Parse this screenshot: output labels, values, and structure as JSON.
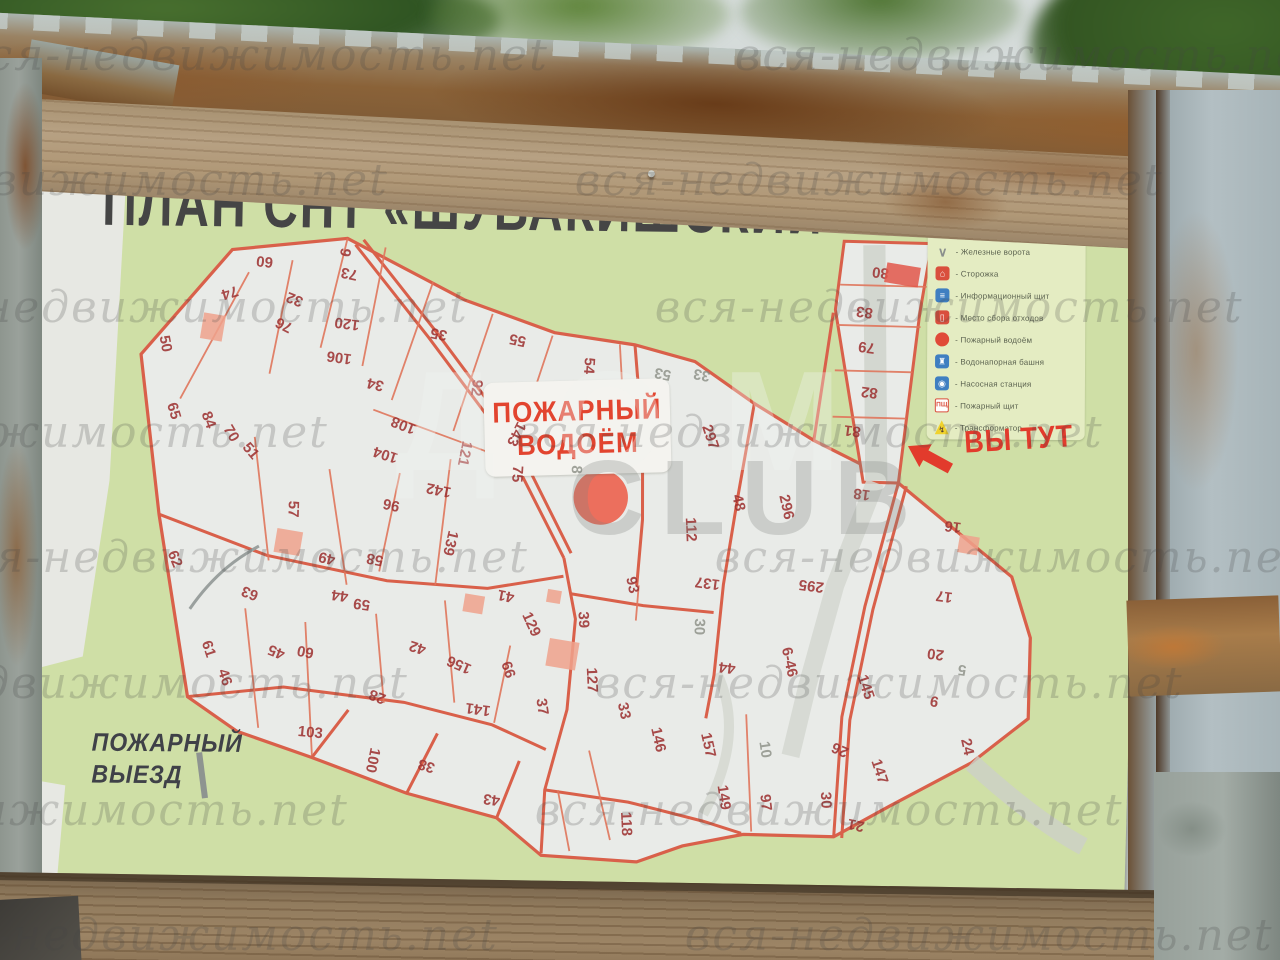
{
  "watermark": {
    "text": "вся-недвижимость.net",
    "center_top": "ДОМ",
    "center_bottom": "CLUB"
  },
  "poster": {
    "title": "ПЛАН СНТ «ШУВАКИШСКИЙ»",
    "you_are_here": "ВЫ ТУТ",
    "fire_pond": {
      "line1": "ПОЖАРНЫЙ",
      "line2": "ВОДОЁМ"
    },
    "fire_exit": {
      "line1": "ПОЖАРНЫЙ",
      "line2": "ВЫЕЗД"
    },
    "legend": {
      "title": "Условные обозначения:",
      "items": [
        {
          "icon": "iron-gates-icon",
          "label": "- Железные ворота"
        },
        {
          "icon": "guard-house-icon",
          "label": "- Сторожка"
        },
        {
          "icon": "info-board-icon",
          "label": "- Информационный щит"
        },
        {
          "icon": "waste-point-icon",
          "label": "- Место сбора отходов"
        },
        {
          "icon": "fire-pond-icon",
          "label": "- Пожарный водоём"
        },
        {
          "icon": "water-tower-icon",
          "label": "- Водонапорная башня"
        },
        {
          "icon": "pump-station-icon",
          "label": "- Насосная станция"
        },
        {
          "icon": "fire-shield-icon",
          "label": "- Пожарный щит",
          "icon_text": "ПЩ"
        },
        {
          "icon": "transformer-icon",
          "label": "- Трансформатор"
        }
      ]
    },
    "colors": {
      "accent_red": "#e23b2c",
      "street_orange": "#d9604a",
      "plot_number_red": "#9e3434",
      "map_green": "#cfdfa6",
      "map_white": "#e9ebe8",
      "legend_bg": "#e4ecc2"
    }
  },
  "map": {
    "fire_pond_circle": {
      "x": 580,
      "y": 349,
      "rad": 27
    },
    "buildings": [
      {
        "x": 273,
        "y": 405,
        "w": 26,
        "h": 24,
        "c": "#efa28c"
      },
      {
        "x": 192,
        "y": 192,
        "w": 22,
        "h": 26,
        "c": "#efa28c"
      },
      {
        "x": 880,
        "y": 122,
        "w": 34,
        "h": 20,
        "c": "#e2574a"
      },
      {
        "x": 953,
        "y": 390,
        "w": 20,
        "h": 18,
        "c": "#efa28c"
      },
      {
        "x": 550,
        "y": 510,
        "w": 30,
        "h": 28,
        "c": "#efa28c"
      },
      {
        "x": 460,
        "y": 462,
        "w": 20,
        "h": 18,
        "c": "#efa28c"
      },
      {
        "x": 540,
        "y": 452,
        "w": 14,
        "h": 13,
        "c": "#efa28c"
      }
    ],
    "plots": [
      {
        "n": "50",
        "x": 145,
        "y": 210,
        "r": 78
      },
      {
        "n": "65",
        "x": 155,
        "y": 277,
        "r": 72
      },
      {
        "n": "74",
        "x": 208,
        "y": 157,
        "r": 162
      },
      {
        "n": "84",
        "x": 190,
        "y": 285,
        "r": 68
      },
      {
        "n": "70",
        "x": 213,
        "y": 298,
        "r": 58
      },
      {
        "n": "51",
        "x": 233,
        "y": 315,
        "r": 48
      },
      {
        "n": "60",
        "x": 242,
        "y": 125,
        "r": 185
      },
      {
        "n": "76",
        "x": 263,
        "y": 188,
        "r": 205
      },
      {
        "n": "32",
        "x": 273,
        "y": 162,
        "r": 200
      },
      {
        "n": "73",
        "x": 327,
        "y": 135,
        "r": 190
      },
      {
        "n": "9",
        "x": 322,
        "y": 114,
        "r": 100
      },
      {
        "n": "120",
        "x": 326,
        "y": 185,
        "r": 186
      },
      {
        "n": "106",
        "x": 319,
        "y": 219,
        "r": 186
      },
      {
        "n": "34",
        "x": 356,
        "y": 245,
        "r": 192
      },
      {
        "n": "35",
        "x": 418,
        "y": 193,
        "r": 190
      },
      {
        "n": "55",
        "x": 497,
        "y": 197,
        "r": 190
      },
      {
        "n": "92",
        "x": 457,
        "y": 246,
        "r": 96
      },
      {
        "n": "54",
        "x": 569,
        "y": 221,
        "r": 92
      },
      {
        "n": "108",
        "x": 385,
        "y": 285,
        "r": 200
      },
      {
        "n": "104",
        "x": 368,
        "y": 315,
        "r": 196
      },
      {
        "n": "121",
        "x": 447,
        "y": 312,
        "r": 100
      },
      {
        "n": "142",
        "x": 422,
        "y": 349,
        "r": 190
      },
      {
        "n": "143",
        "x": 498,
        "y": 291,
        "r": 115
      },
      {
        "n": "75",
        "x": 500,
        "y": 331,
        "r": 92
      },
      {
        "n": "96",
        "x": 375,
        "y": 365,
        "r": 190
      },
      {
        "n": "139",
        "x": 435,
        "y": 402,
        "r": 102
      },
      {
        "n": "57",
        "x": 277,
        "y": 372,
        "r": 90
      },
      {
        "n": "58",
        "x": 360,
        "y": 420,
        "r": 190
      },
      {
        "n": "49",
        "x": 312,
        "y": 420,
        "r": 192
      },
      {
        "n": "44",
        "x": 326,
        "y": 457,
        "r": 186
      },
      {
        "n": "59",
        "x": 348,
        "y": 465,
        "r": 186
      },
      {
        "n": "62",
        "x": 160,
        "y": 425,
        "r": 66
      },
      {
        "n": "63",
        "x": 236,
        "y": 457,
        "r": 200
      },
      {
        "n": "61",
        "x": 196,
        "y": 514,
        "r": 70
      },
      {
        "n": "46",
        "x": 213,
        "y": 542,
        "r": 70
      },
      {
        "n": "45",
        "x": 264,
        "y": 515,
        "r": 200
      },
      {
        "n": "60",
        "x": 293,
        "y": 514,
        "r": 190
      },
      {
        "n": "42",
        "x": 405,
        "y": 507,
        "r": 196
      },
      {
        "n": "156",
        "x": 447,
        "y": 523,
        "r": 202
      },
      {
        "n": "41",
        "x": 492,
        "y": 453,
        "r": 190
      },
      {
        "n": "129",
        "x": 518,
        "y": 481,
        "r": 64
      },
      {
        "n": "39",
        "x": 570,
        "y": 475,
        "r": 86
      },
      {
        "n": "66",
        "x": 496,
        "y": 527,
        "r": 70
      },
      {
        "n": "37",
        "x": 531,
        "y": 563,
        "r": 80
      },
      {
        "n": "127",
        "x": 580,
        "y": 535,
        "r": 86
      },
      {
        "n": "33",
        "x": 613,
        "y": 565,
        "r": 76
      },
      {
        "n": "146",
        "x": 648,
        "y": 593,
        "r": 76
      },
      {
        "n": "103",
        "x": 300,
        "y": 595,
        "r": 4
      },
      {
        "n": "100",
        "x": 363,
        "y": 621,
        "r": 100
      },
      {
        "n": "38",
        "x": 417,
        "y": 625,
        "r": 196
      },
      {
        "n": "28",
        "x": 366,
        "y": 557,
        "r": 200
      },
      {
        "n": "141",
        "x": 467,
        "y": 567,
        "r": 186
      },
      {
        "n": "43",
        "x": 483,
        "y": 657,
        "r": 186
      },
      {
        "n": "118",
        "x": 618,
        "y": 678,
        "r": 86
      },
      {
        "n": "157",
        "x": 698,
        "y": 597,
        "r": 76
      },
      {
        "n": "10",
        "x": 755,
        "y": 600,
        "r": 80,
        "g": 1
      },
      {
        "n": "149",
        "x": 715,
        "y": 649,
        "r": 80
      },
      {
        "n": "97",
        "x": 757,
        "y": 653,
        "r": 82
      },
      {
        "n": "30",
        "x": 817,
        "y": 649,
        "r": 86
      },
      {
        "n": "21",
        "x": 848,
        "y": 673,
        "r": 190
      },
      {
        "n": "26",
        "x": 830,
        "y": 598,
        "r": 202
      },
      {
        "n": "147",
        "x": 870,
        "y": 619,
        "r": 70
      },
      {
        "n": "145",
        "x": 854,
        "y": 535,
        "r": 70
      },
      {
        "n": "9",
        "x": 923,
        "y": 547,
        "r": 190
      },
      {
        "n": "24",
        "x": 957,
        "y": 592,
        "r": 76
      },
      {
        "n": "20",
        "x": 923,
        "y": 500,
        "r": 186
      },
      {
        "n": "5",
        "x": 950,
        "y": 515,
        "r": 186,
        "g": 1
      },
      {
        "n": "17",
        "x": 930,
        "y": 442,
        "r": 186
      },
      {
        "n": "16",
        "x": 937,
        "y": 372,
        "r": 186
      },
      {
        "n": "18",
        "x": 845,
        "y": 342,
        "r": 186
      },
      {
        "n": "297",
        "x": 692,
        "y": 289,
        "r": 70
      },
      {
        "n": "48",
        "x": 722,
        "y": 354,
        "r": 76
      },
      {
        "n": "296",
        "x": 770,
        "y": 357,
        "r": 76
      },
      {
        "n": "112",
        "x": 675,
        "y": 382,
        "r": 86
      },
      {
        "n": "137",
        "x": 693,
        "y": 435,
        "r": 186
      },
      {
        "n": "295",
        "x": 797,
        "y": 435,
        "r": 186
      },
      {
        "n": "93",
        "x": 618,
        "y": 439,
        "r": 76
      },
      {
        "n": "30",
        "x": 686,
        "y": 479,
        "r": 90,
        "g": 1
      },
      {
        "n": "6-46",
        "x": 777,
        "y": 512,
        "r": 76
      },
      {
        "n": "44",
        "x": 715,
        "y": 519,
        "r": 186
      },
      {
        "n": "80",
        "x": 858,
        "y": 120,
        "r": 186
      },
      {
        "n": "83",
        "x": 843,
        "y": 160,
        "r": 186
      },
      {
        "n": "79",
        "x": 846,
        "y": 195,
        "r": 186
      },
      {
        "n": "82",
        "x": 850,
        "y": 240,
        "r": 186
      },
      {
        "n": "81",
        "x": 834,
        "y": 279,
        "r": 186
      },
      {
        "n": "53",
        "x": 643,
        "y": 227,
        "r": 190,
        "g": 1
      },
      {
        "n": "33",
        "x": 682,
        "y": 227,
        "r": 190,
        "g": 1
      },
      {
        "n": "8",
        "x": 559,
        "y": 325,
        "r": 92,
        "g": 1
      }
    ]
  }
}
